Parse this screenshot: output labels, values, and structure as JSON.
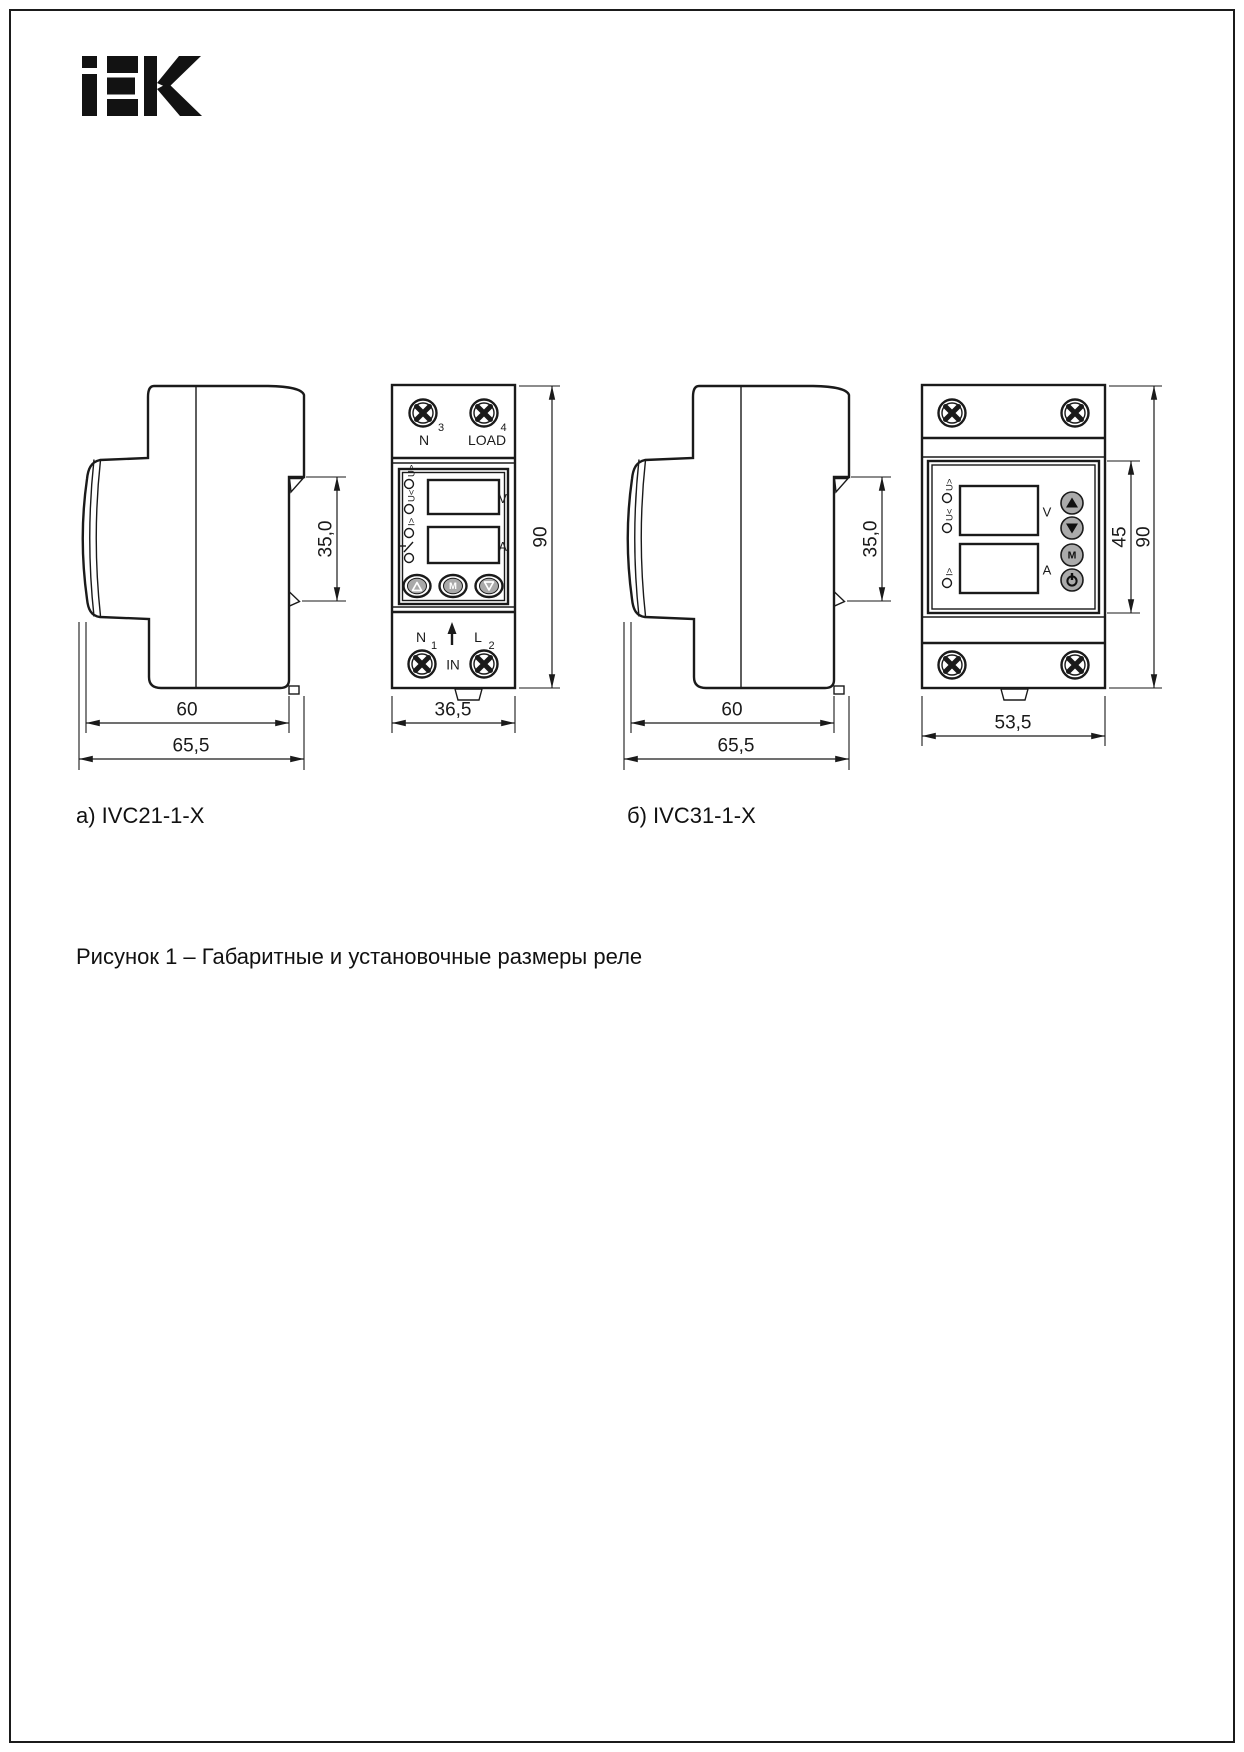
{
  "page": {
    "logo_text": "IEK",
    "figure_caption": "Рисунок 1 – Габаритные и установочные размеры реле"
  },
  "icons": {
    "screw": "phillips-screw",
    "up_button": "triangle-up",
    "down_button": "triangle-down",
    "power_button": "power-symbol",
    "input_arrow": "arrow-up",
    "led": "indicator-circle",
    "relay_contact": "open-contact-symbol"
  },
  "device_a": {
    "caption": "а) IVC21-1-X",
    "side": {
      "dim_notch": "35,0",
      "dim_depth": "60",
      "dim_depth_total": "65,5"
    },
    "front": {
      "dim_width": "36,5",
      "dim_height": "90",
      "terminal_top_left": "N",
      "terminal_top_left_num": "3",
      "terminal_top_right": "LOAD",
      "terminal_top_right_num": "4",
      "led_labels": [
        "U>",
        "U<",
        "I>"
      ],
      "display_v": "V",
      "display_a": "A",
      "btn_mode": "M",
      "terminal_bottom_left": "N",
      "terminal_bottom_left_num": "1",
      "terminal_bottom_right": "L",
      "terminal_bottom_right_num": "2",
      "terminal_bottom_center": "IN"
    }
  },
  "device_b": {
    "caption": "б) IVC31-1-X",
    "side": {
      "dim_notch": "35,0",
      "dim_depth": "60",
      "dim_depth_total": "65,5"
    },
    "front": {
      "dim_width": "53,5",
      "dim_height": "90",
      "dim_panel_height": "45",
      "led_labels": [
        "U>",
        "U<",
        "I>"
      ],
      "display_v": "V",
      "display_a": "A",
      "btn_mode": "M"
    }
  }
}
